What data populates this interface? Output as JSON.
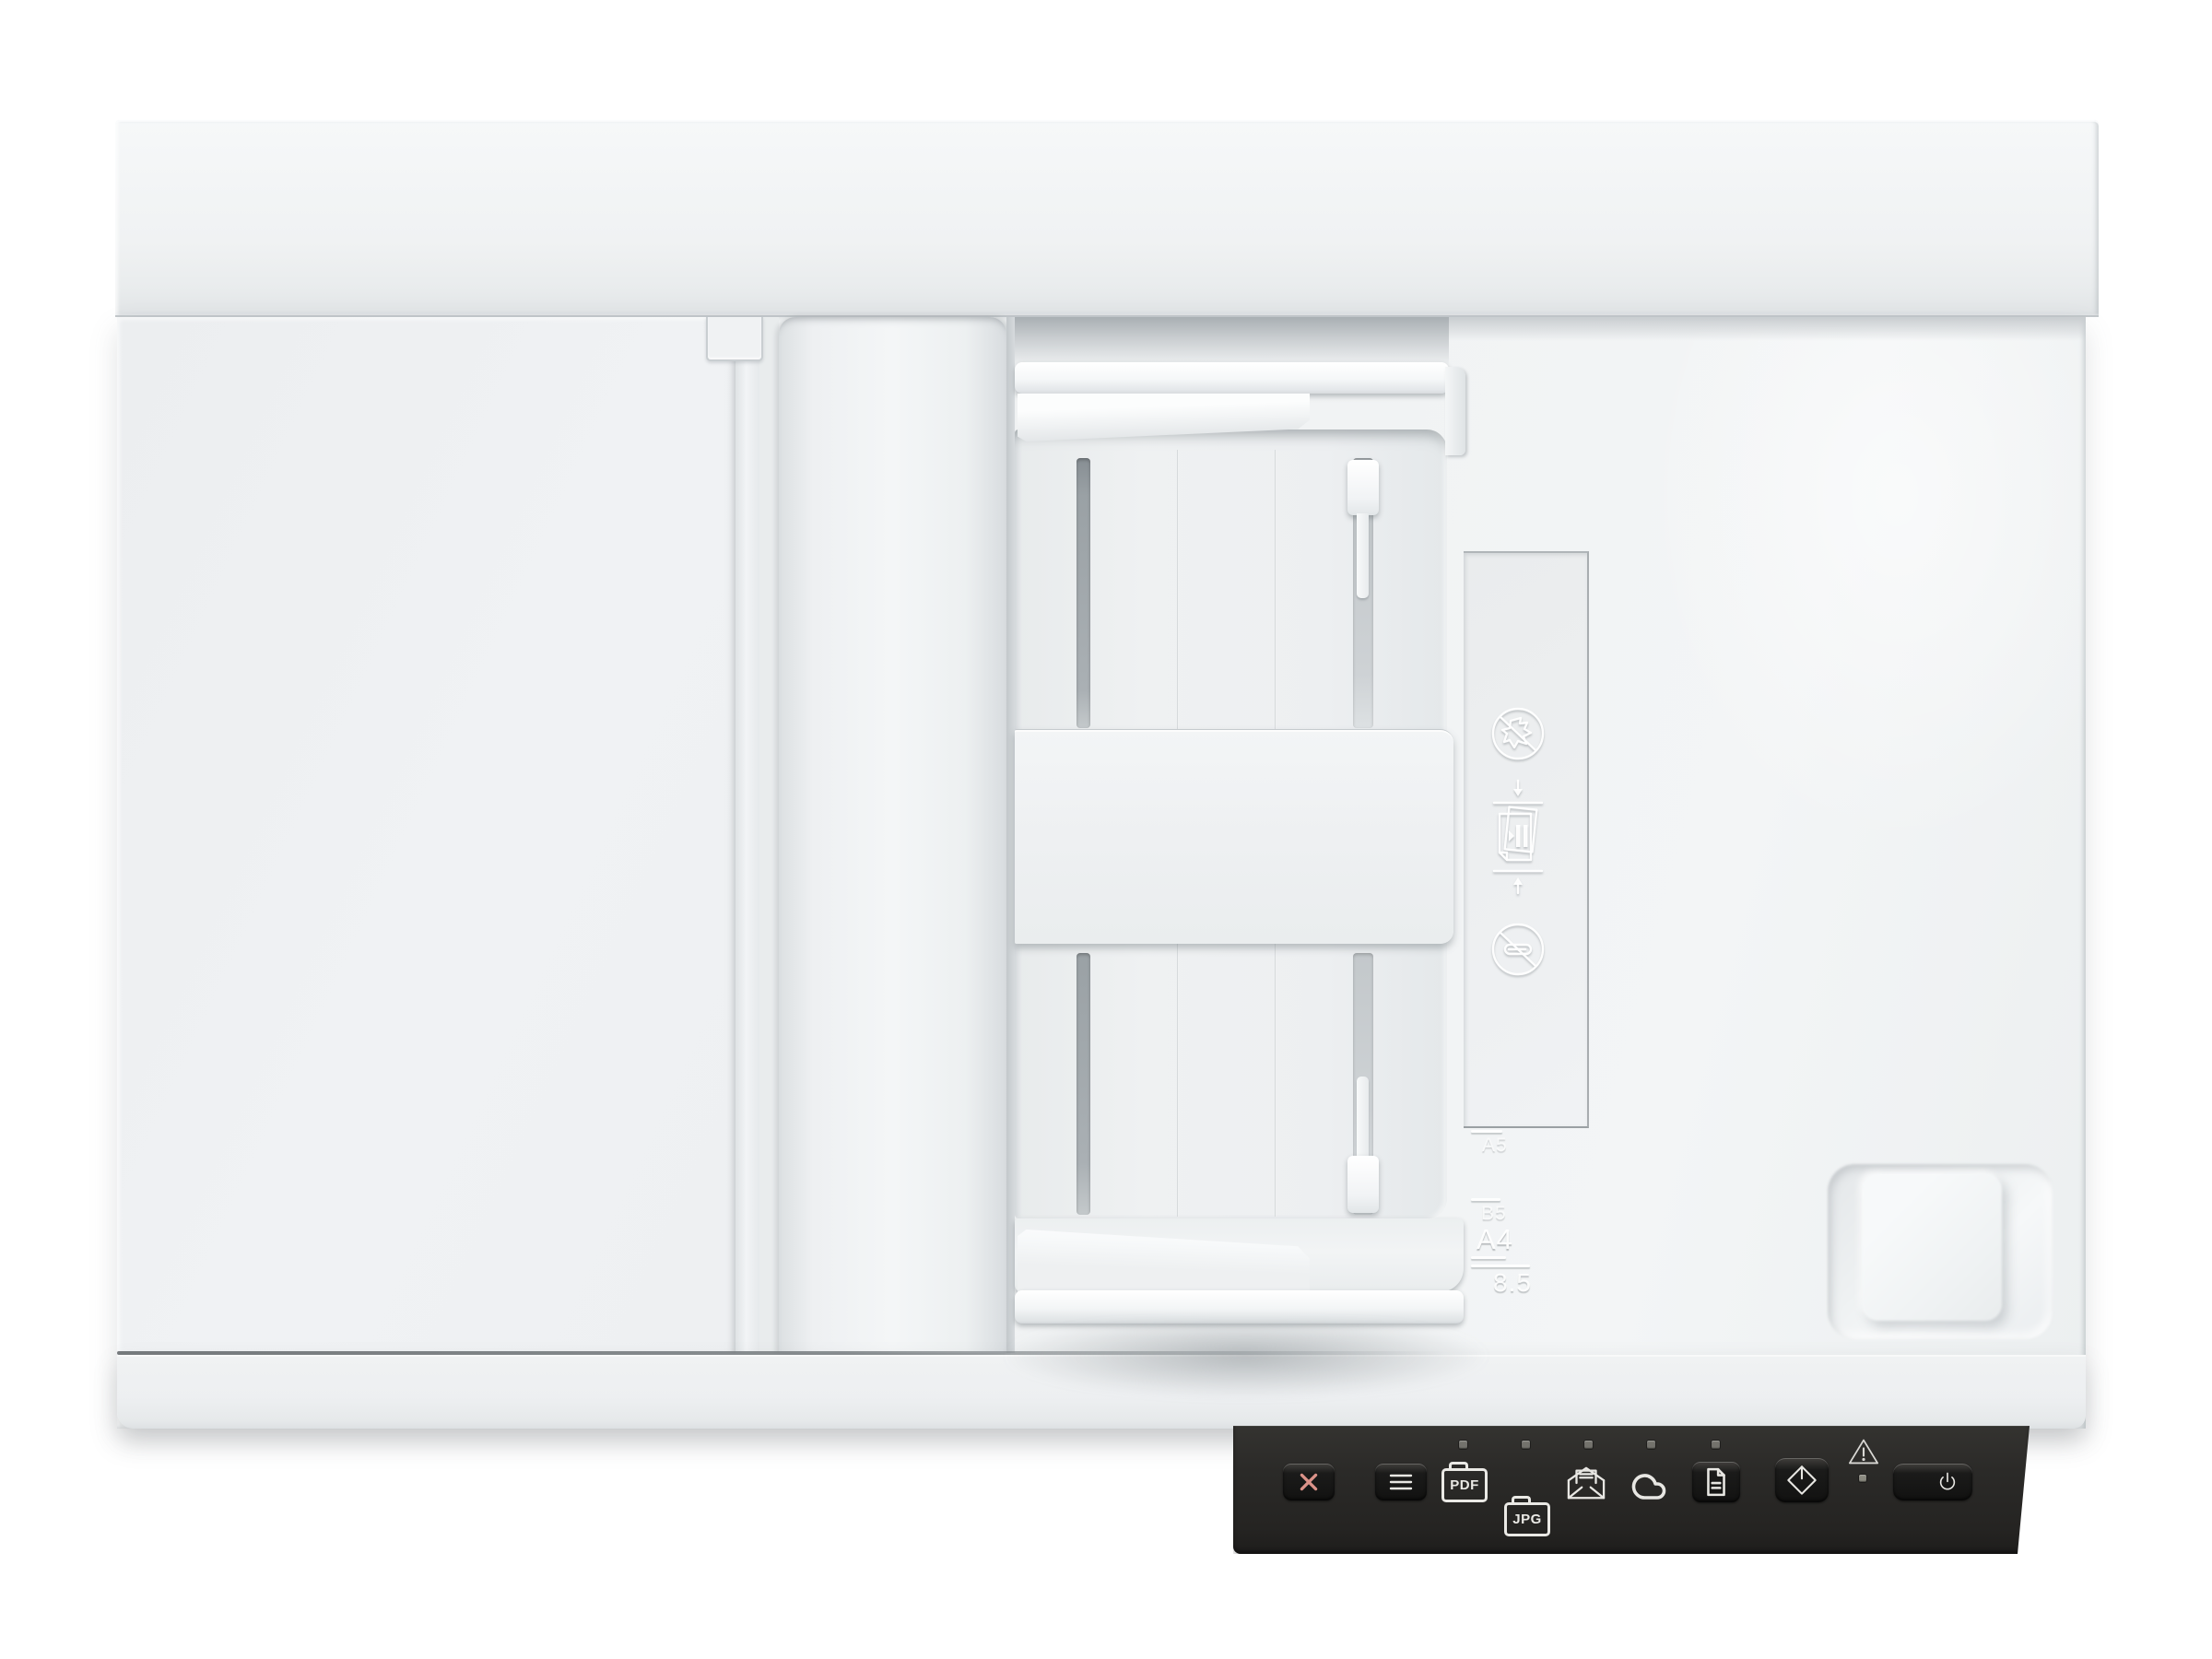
{
  "scene": {
    "type": "product-photo",
    "subject": "White flatbed document scanner with automatic document feeder, viewed from directly above",
    "background_color": "#ffffff",
    "body_color": "#eff1f2",
    "control_panel_color": "#2b2a28",
    "cancel_accent_color": "#db9289",
    "glyph_color": "#e8e7e3",
    "led_color": "#73726c"
  },
  "adf": {
    "embossed_icons": [
      {
        "name": "no-damaged-paper-icon",
        "meaning": "do not load torn or damaged originals"
      },
      {
        "name": "load-originals-icon",
        "meaning": "load originals between the guides"
      },
      {
        "name": "no-paperclips-icon",
        "meaning": "remove staples and paper clips"
      }
    ],
    "paper_size_scale": {
      "sizes": [
        {
          "label": "A5"
        },
        {
          "label": "B5"
        },
        {
          "label": "A4"
        },
        {
          "label": "8.5"
        }
      ]
    }
  },
  "control_panel": {
    "buttons": {
      "cancel": {
        "icon": "x-icon"
      },
      "menu": {
        "icon": "hamburger-icon"
      },
      "document": {
        "icon": "document-icon",
        "led": true
      },
      "start_scan": {
        "icon": "start-scan-icon"
      },
      "power": {
        "icon": "power-icon"
      }
    },
    "destinations": [
      {
        "id": "pdf",
        "label": "PDF",
        "icon": "pdf-folder-icon",
        "led": true
      },
      {
        "id": "jpg",
        "label": "JPG",
        "icon": "jpg-folder-icon",
        "led": true
      },
      {
        "id": "email",
        "icon": "email-icon",
        "led": true
      },
      {
        "id": "cloud",
        "icon": "cloud-icon",
        "led": true
      }
    ],
    "indicators": {
      "warning": {
        "icon": "warning-triangle-icon"
      },
      "status_led": true
    }
  }
}
